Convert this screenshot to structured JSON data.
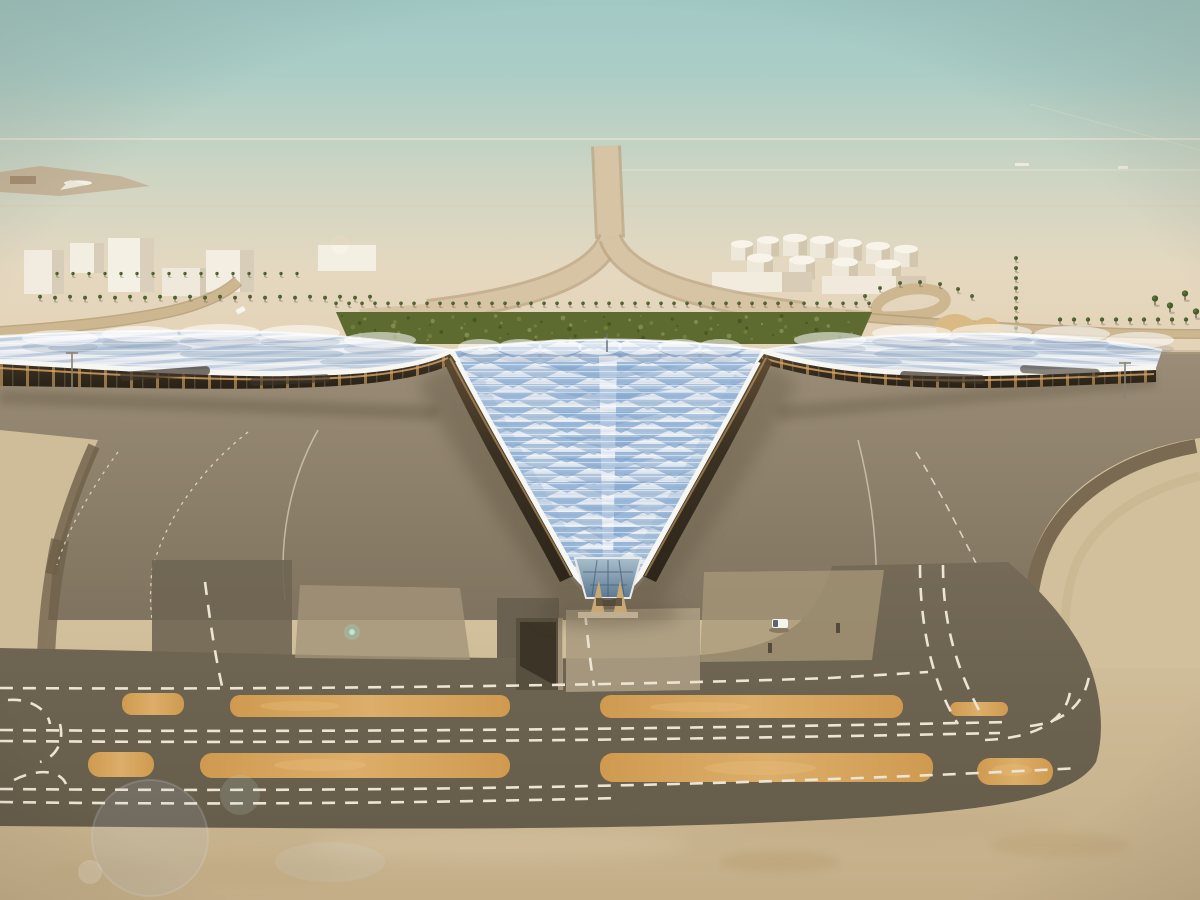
{
  "scene": {
    "kind": "aerial-architectural-rendering",
    "subject": "airport-terminal-with-trefoil-canopy-roof-in-desert",
    "visible_counts": {
      "left_pier_aircraft": 5,
      "right_pier_aircraft": 5,
      "left_wing_aircraft": 3,
      "right_wing_aircraft": 3,
      "ground_vehicles": 2
    }
  },
  "airline": {
    "title": "KUWAIT",
    "title_arabic": "الكويتية",
    "title_color": "#24407a",
    "tail_teal": "#3ec3cb",
    "tail_blue": "#1565a5"
  },
  "palette": {
    "sky_top": "#a2c9c5",
    "sky_haze": "#e5d8c0",
    "desert": "#e2cfae",
    "sand_foreground": "#cdbb98",
    "apron_grey": "#8b7e68",
    "taxiway_dark": "#6f6553",
    "shoulder_orange": "#d49c52",
    "roof_silver": "#dfe5ea",
    "roof_blue": "#86a9cf",
    "roof_edge_white": "#f6f6f3",
    "facade_dark": "#382e20",
    "facade_glow": "#d3a05f",
    "greenery": "#5d6a30",
    "marking_white": "#e9e2d2"
  }
}
